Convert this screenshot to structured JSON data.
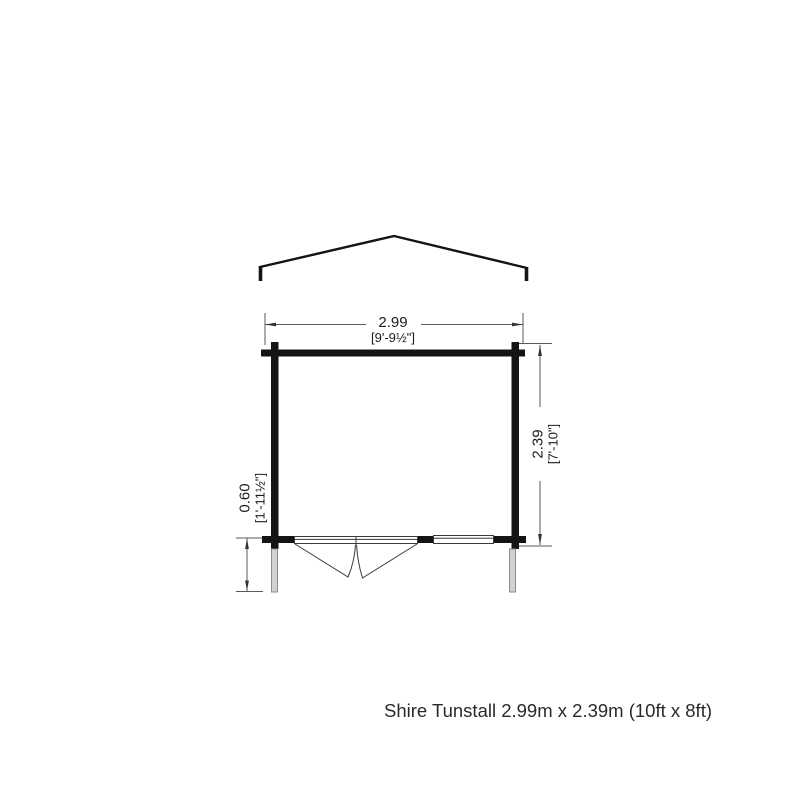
{
  "plan": {
    "caption": "Shire Tunstall 2.99m x 2.39m (10ft x 8ft)",
    "width": {
      "metric": "2.99",
      "imperial": "[9'-9½\"]"
    },
    "depth": {
      "metric": "2.39",
      "imperial": "[7'-10\"]"
    },
    "overhang": {
      "metric": "0.60",
      "imperial": "[1'-11½\"]"
    },
    "colors": {
      "wall": "#141414",
      "dimension_line": "#5a5a5a",
      "post_fill": "#d2d2d2",
      "post_stroke": "#8c8c8c"
    }
  }
}
